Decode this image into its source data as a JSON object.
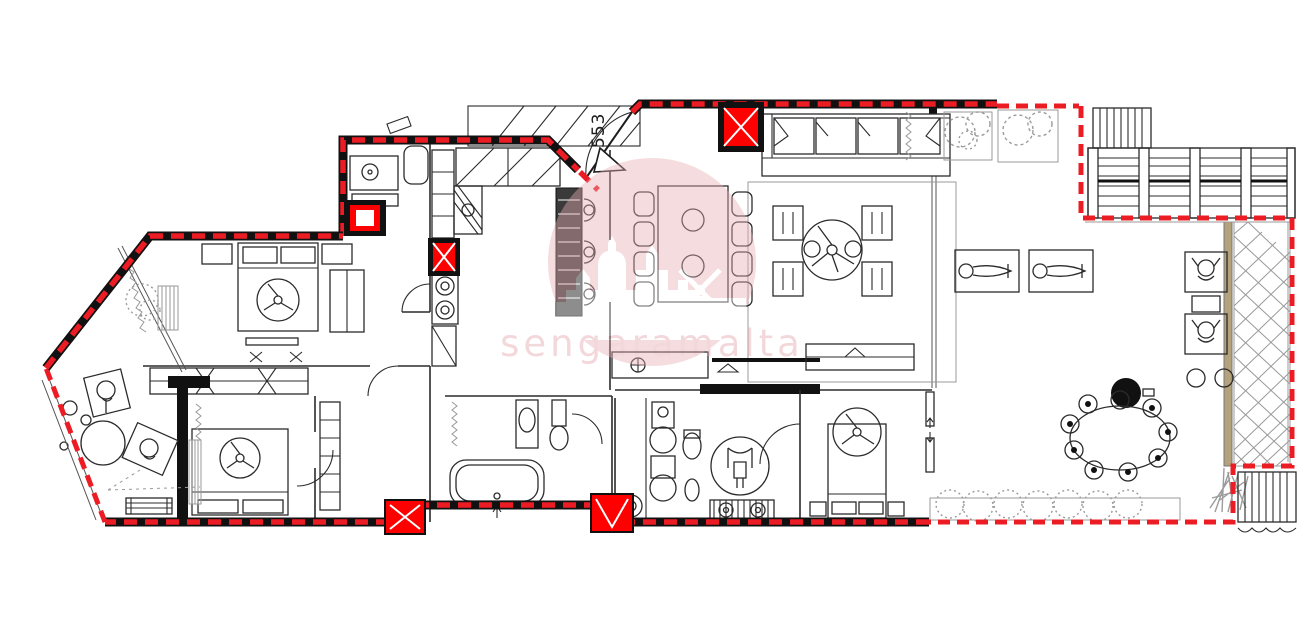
{
  "plan": {
    "unit_label": "553",
    "watermark": {
      "text": "sengaramalta"
    },
    "colors": {
      "red": "#ec1c24",
      "colred": "#fe0000",
      "blk": "#111111",
      "ln": "#2b2b2b",
      "mid": "#555555",
      "lt": "#999999",
      "plant": "#9b9b9b",
      "tan": "#b3a27c",
      "wmfill": "#e8aeb4",
      "wmtext": "#e3a4ab"
    }
  }
}
